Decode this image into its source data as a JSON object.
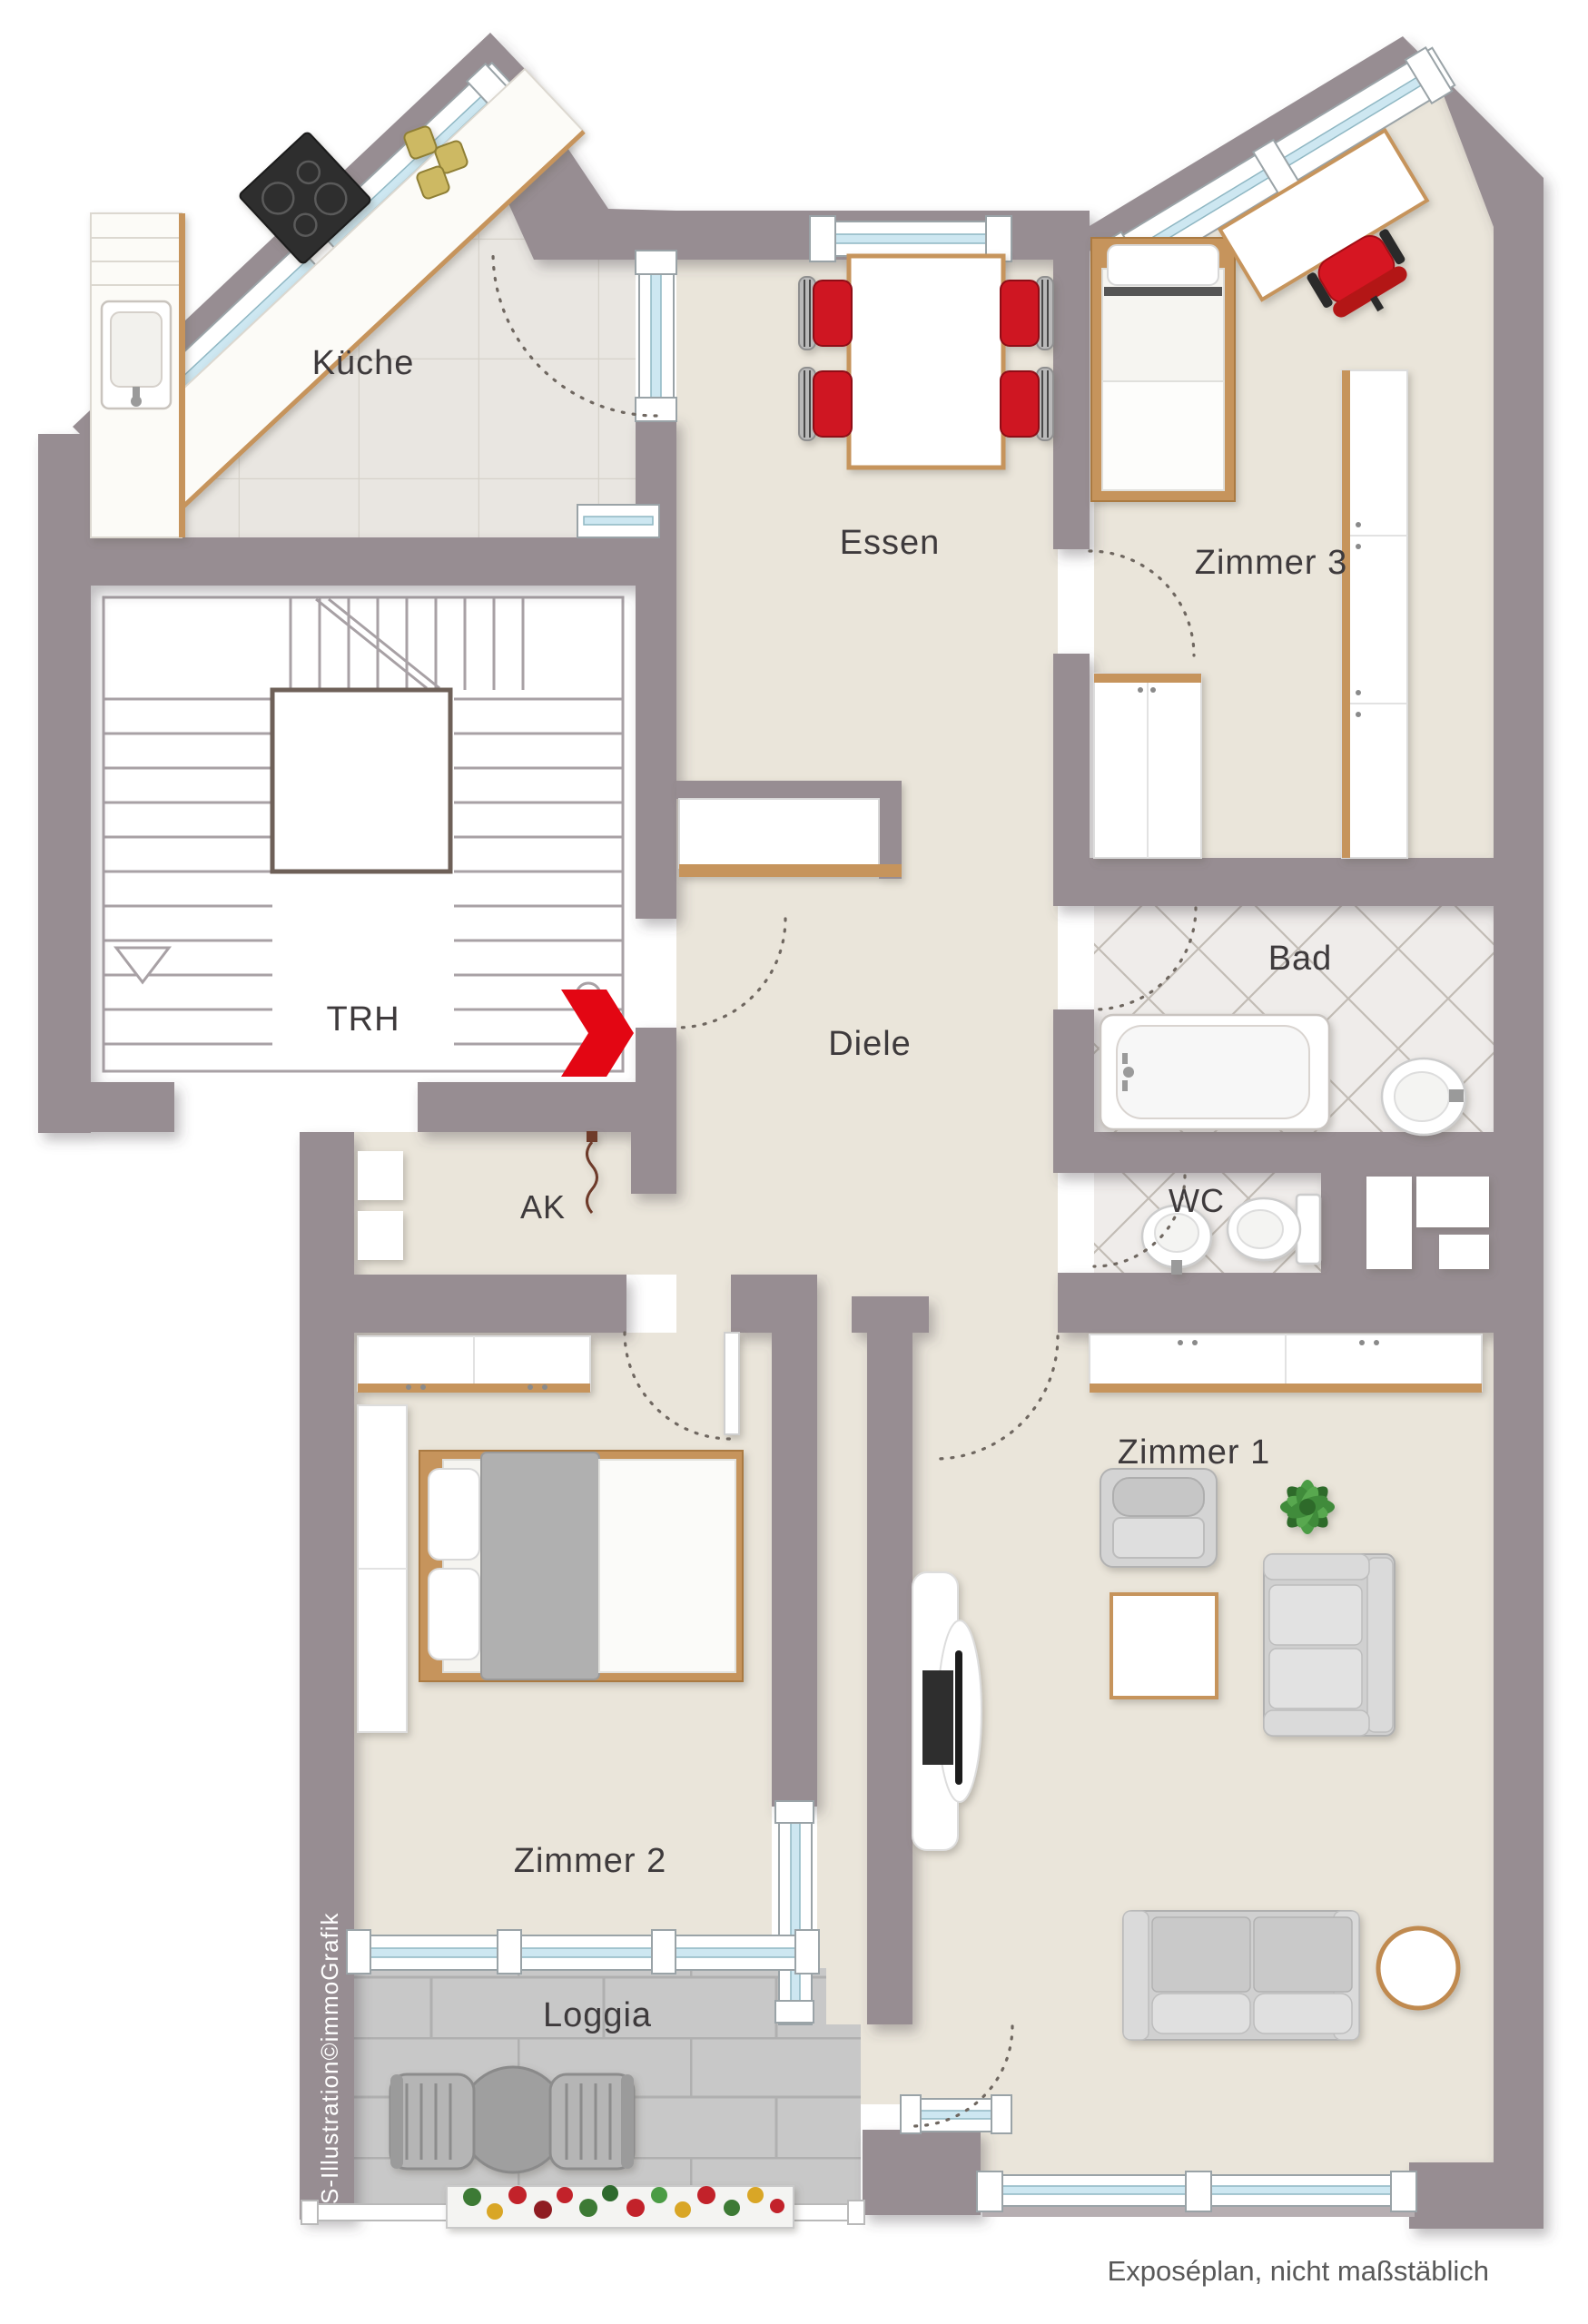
{
  "plan": {
    "rooms": {
      "kueche": {
        "label": "Küche"
      },
      "essen": {
        "label": "Essen"
      },
      "zimmer3": {
        "label": "Zimmer 3"
      },
      "trh": {
        "label": "TRH"
      },
      "diele": {
        "label": "Diele"
      },
      "bad": {
        "label": "Bad"
      },
      "wc": {
        "label": "WC"
      },
      "ak": {
        "label": "AK"
      },
      "zimmer1": {
        "label": "Zimmer 1"
      },
      "zimmer2": {
        "label": "Zimmer 2"
      },
      "loggia": {
        "label": "Loggia"
      }
    },
    "footer": {
      "note": "Exposéplan, nicht maßstäblich"
    },
    "credit": {
      "text": "S-Illustration©immoGrafik"
    },
    "colors": {
      "wall": "#978d92",
      "floor_beige": "#eae5da",
      "kitchen_floor": "#e9e6e1",
      "bath_tile": "#efecea",
      "loggia_tile": "#c8c8c8",
      "window_glass": "#cde7f1",
      "wood": "#c6945c",
      "accent_red": "#e30613",
      "chair_red": "#cf1420",
      "furniture_gray": "#d4d4d4",
      "label_text": "#3e3a3c",
      "footer_text": "#595959"
    }
  }
}
